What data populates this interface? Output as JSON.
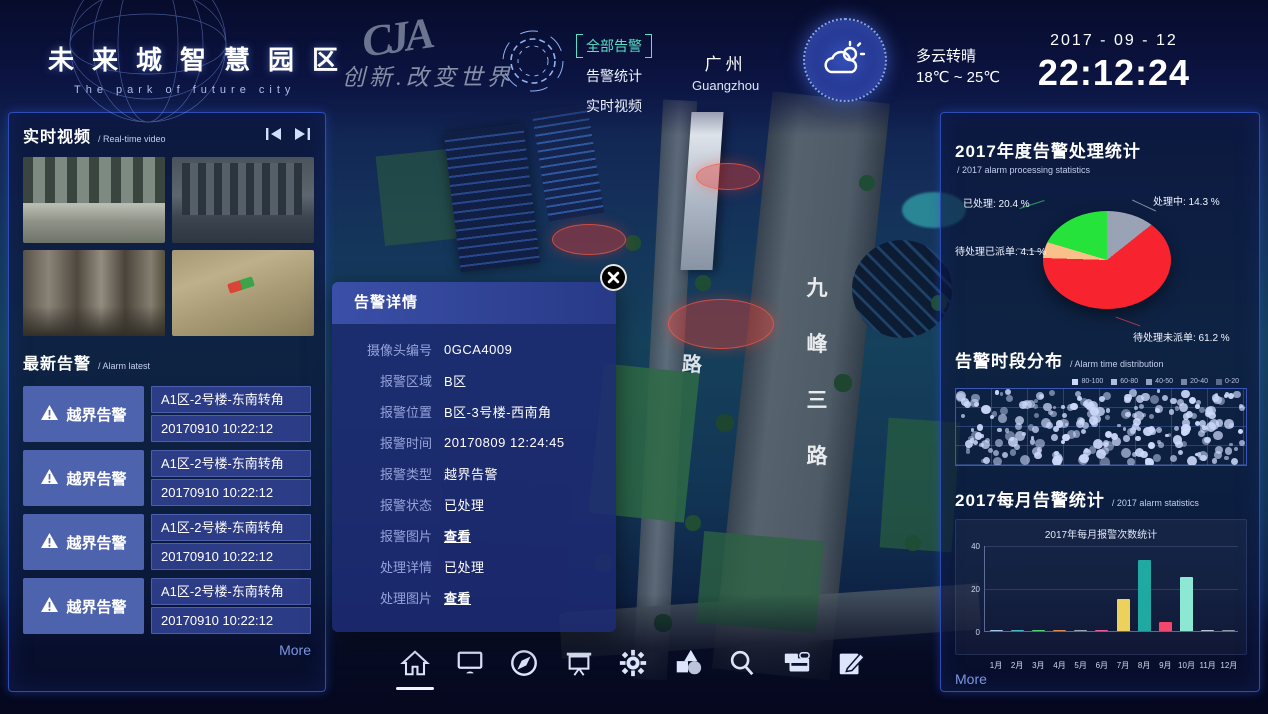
{
  "header": {
    "title": "未来城智慧园区",
    "subtitle": "The park of future city",
    "logo_text": "CJA",
    "slogan": "创新.改变世界",
    "nav": [
      {
        "label": "全部告警",
        "active": true
      },
      {
        "label": "告警统计",
        "active": false
      },
      {
        "label": "实时视频",
        "active": false
      }
    ],
    "city": {
      "name": "广州",
      "en": "Guangzhou"
    },
    "weather": {
      "condition": "多云转晴",
      "range": "18℃ ~ 25℃",
      "icon": "sun-cloud-icon"
    },
    "date": "2017 - 09 - 12",
    "time": "22:12:24"
  },
  "left_panel": {
    "video_section": {
      "title": "实时视频",
      "subtitle": "/ Real-time video"
    },
    "videos": [
      "street-intersection-cam",
      "building-palms-cam",
      "lobby-corridor-cam",
      "stairs-closeup-cam"
    ],
    "alarm_section": {
      "title": "最新告警",
      "subtitle": "/ Alarm latest"
    },
    "alarms": [
      {
        "type": "越界告警",
        "location": "A1区-2号楼-东南转角",
        "time": "20170910 10:22:12"
      },
      {
        "type": "越界告警",
        "location": "A1区-2号楼-东南转角",
        "time": "20170910 10:22:12"
      },
      {
        "type": "越界告警",
        "location": "A1区-2号楼-东南转角",
        "time": "20170910 10:22:12"
      },
      {
        "type": "越界告警",
        "location": "A1区-2号楼-东南转角",
        "time": "20170910 10:22:12"
      }
    ],
    "more_label": "More"
  },
  "popup": {
    "title": "告警详情",
    "rows": [
      {
        "label": "摄像头编号",
        "value": "0GCA4009",
        "link": false
      },
      {
        "label": "报警区域",
        "value": "B区",
        "link": false
      },
      {
        "label": "报警位置",
        "value": "B区-3号楼-西南角",
        "link": false
      },
      {
        "label": "报警时间",
        "value": "20170809 12:24:45",
        "link": false
      },
      {
        "label": "报警类型",
        "value": "越界告警",
        "link": false
      },
      {
        "label": "报警状态",
        "value": "已处理",
        "link": false
      },
      {
        "label": "报警图片",
        "value": "查看",
        "link": true
      },
      {
        "label": "处理详情",
        "value": "已处理",
        "link": false
      },
      {
        "label": "处理图片",
        "value": "查看",
        "link": true
      }
    ]
  },
  "map": {
    "street_main": "九峰三路",
    "street_side": "路",
    "alarm_zones_count": 3
  },
  "right_panel": {
    "more_label": "More"
  },
  "chart_data": [
    {
      "type": "pie",
      "title": "2017年度告警处理统计",
      "subtitle": "/ 2017 alarm processing statistics",
      "slices": [
        {
          "label": "处理中",
          "value": 14.3,
          "color": "#9aa3b5"
        },
        {
          "label": "待处理未派单",
          "value": 61.2,
          "color": "#f7232e"
        },
        {
          "label": "待处理已派单",
          "value": 4.1,
          "color": "#f9c08a"
        },
        {
          "label": "已处理",
          "value": 20.4,
          "color": "#25e33b"
        }
      ],
      "unit": "%"
    },
    {
      "type": "scatter",
      "title": "告警时段分布",
      "subtitle": "/ Alarm time distribution",
      "legend": [
        "80-100",
        "60-80",
        "40-50",
        "20-40",
        "0-20"
      ],
      "points_count": 240,
      "seed": 42,
      "note": "dense distribution of alarm counts across time-of-day; individual point values not labeled in source"
    },
    {
      "type": "bar",
      "title": "2017每月告警统计",
      "subtitle": "/ 2017 alarm statistics",
      "inner_title": "2017年每月报警次数统计",
      "categories": [
        "1月",
        "2月",
        "3月",
        "4月",
        "5月",
        "6月",
        "7月",
        "8月",
        "9月",
        "10月",
        "11月",
        "12月"
      ],
      "values": [
        0.5,
        0.5,
        0.7,
        0.7,
        0.6,
        0.7,
        15,
        33,
        4,
        25,
        0.5,
        0.5
      ],
      "colors": [
        "#9fc6e8",
        "#49b8c8",
        "#4fd06a",
        "#e08a4a",
        "#9aa6b5",
        "#e85a9a",
        "#ecd25c",
        "#1fa9a2",
        "#f4476b",
        "#8ce8d3",
        "#b8c4d4",
        "#8a98a8"
      ],
      "ylim": [
        0,
        40
      ],
      "yticks": [
        0,
        20,
        40
      ]
    }
  ],
  "toolbar": {
    "active": "home",
    "icons": [
      "home",
      "monitor",
      "compass",
      "projection-screen",
      "gear",
      "shapes",
      "search",
      "card-reader",
      "edit"
    ]
  }
}
